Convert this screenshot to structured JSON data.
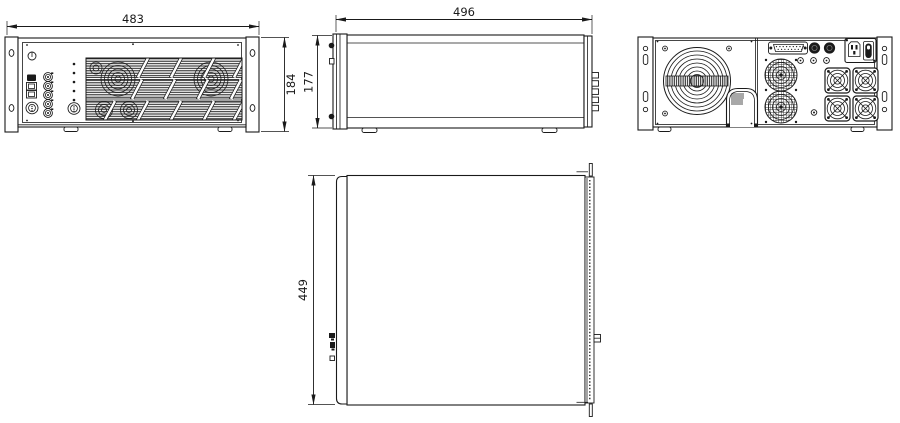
{
  "drawing": {
    "type": "technical-dimension-drawing",
    "views": {
      "front": {
        "width_label": "483",
        "height_label": "184"
      },
      "side": {
        "depth_label": "496",
        "height_label": "177"
      },
      "rear": {},
      "top": {
        "depth_label": "449"
      }
    },
    "colors": {
      "line": "#1a1a1a",
      "background": "#ffffff"
    }
  }
}
